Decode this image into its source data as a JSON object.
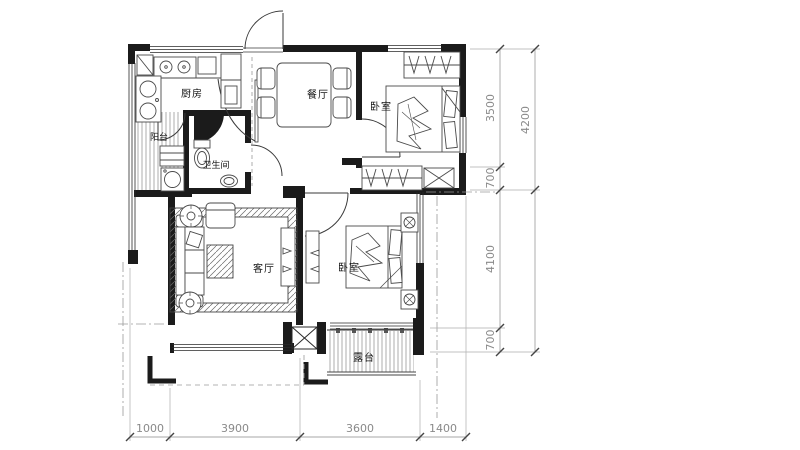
{
  "drawing": {
    "rooms": {
      "kitchen": "厨房",
      "dining": "餐厅",
      "bedroom_top": "卧室",
      "bathroom": "卫生间",
      "balcony": "阳台",
      "living": "客厅",
      "bedroom_right": "卧室",
      "terrace": "露台"
    },
    "dimensions": {
      "bottom": [
        "1000",
        "3900",
        "3600",
        "1400"
      ],
      "right_inner": [
        "3500",
        "700",
        "4100",
        "700"
      ],
      "right_outer": [
        "4200"
      ]
    },
    "colors": {
      "wall": "#1b1b1b",
      "furniture_line": "#4a4a4a",
      "dimension_text": "#8a8a8a",
      "background": "#ffffff"
    }
  }
}
